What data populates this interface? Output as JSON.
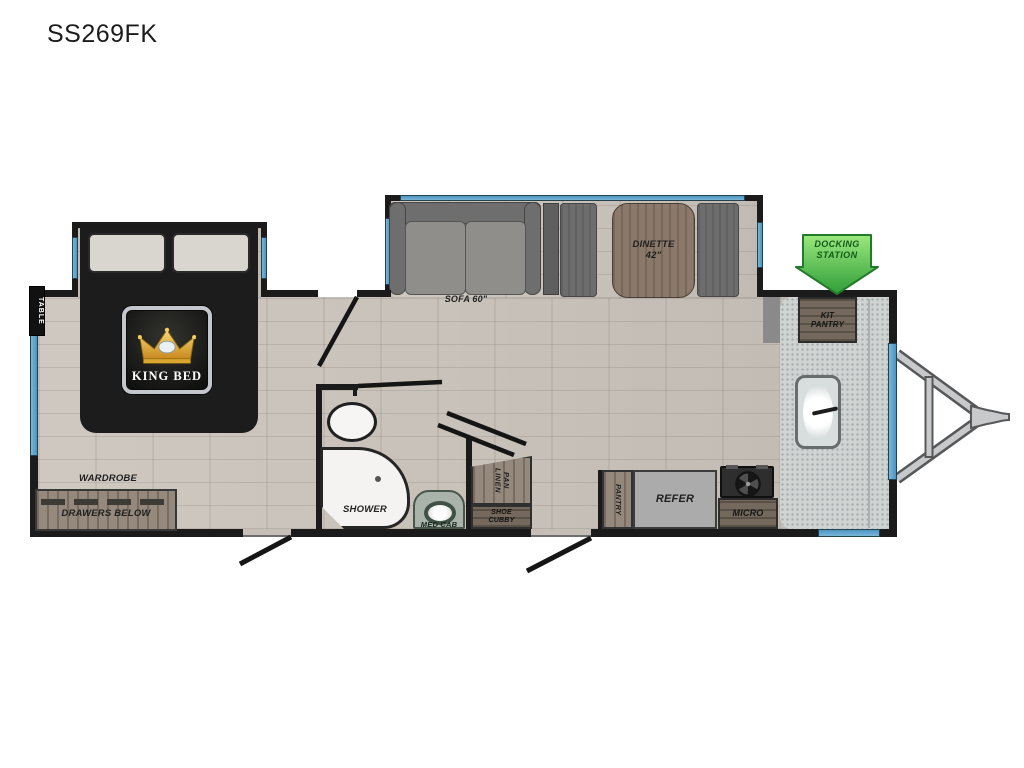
{
  "title": "SS269FK",
  "colors": {
    "wall": "#1b1b1b",
    "floor": "#c9c2ba",
    "window_blue": "#5ba3cb",
    "docking_green": "#55bb4a",
    "crown_gold": "#e5b13d",
    "counter": "#cfd4d3",
    "wood": "#95897d",
    "bed": "#1c1c1c"
  },
  "labels": {
    "table": "TABLE",
    "king_bed": "KING BED",
    "wardrobe": "WARDROBE",
    "drawers_below": "DRAWERS BELOW",
    "sofa": "SOFA 60\"",
    "dinette": "DINETTE",
    "dinette_size": "42\"",
    "docking1": "DOCKING",
    "docking2": "STATION",
    "kit": "KIT",
    "kit_pantry": "PANTRY",
    "shower": "SHOWER",
    "med_cab": "MED CAB",
    "pan": "PAN",
    "linen": "LINEN",
    "shoe": "SHOE",
    "cubby": "CUBBY",
    "pantry": "PANTRY",
    "refer": "REFER",
    "micro": "MICRO"
  }
}
